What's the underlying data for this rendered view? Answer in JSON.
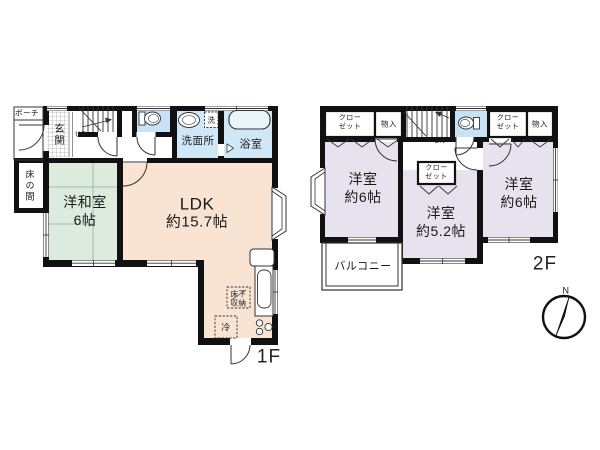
{
  "title": "戸建て間取り図",
  "floor1": {
    "label": "1F",
    "porch": "ポーチ",
    "entrance": "玄関",
    "stairs": "UP",
    "washroom": "洗面所",
    "washer": "洗",
    "bathroom": "浴室",
    "tokonoma": "床の間",
    "japanese_room": {
      "name": "洋和室",
      "size": "6帖"
    },
    "ldk": {
      "name": "LDK",
      "size": "約15.7帖"
    },
    "underfloor_storage": {
      "line1": "床下",
      "line2": "収納"
    },
    "refrigerator": "冷"
  },
  "floor2": {
    "label": "2F",
    "closet": {
      "line1": "クロー",
      "line2": "ゼット"
    },
    "storage": "物入",
    "stairs": "DN",
    "bedroom_left": {
      "name": "洋室",
      "size": "約6帖"
    },
    "bedroom_middle": {
      "name": "洋室",
      "size": "約5.2帖"
    },
    "bedroom_right": {
      "name": "洋室",
      "size": "約6帖"
    },
    "balcony": "バルコニー"
  },
  "compass": {
    "north": "N"
  },
  "colors": {
    "wall": "#111111",
    "ldk_fill": "#f9e3d3",
    "tatami_fill": "#dcebdd",
    "water_fill": "#cfe7f6",
    "toilet_fill": "#c7e2f4",
    "bedroom_fill": "#e8e2ef",
    "bathtub_fill": "#e9f4fb"
  }
}
